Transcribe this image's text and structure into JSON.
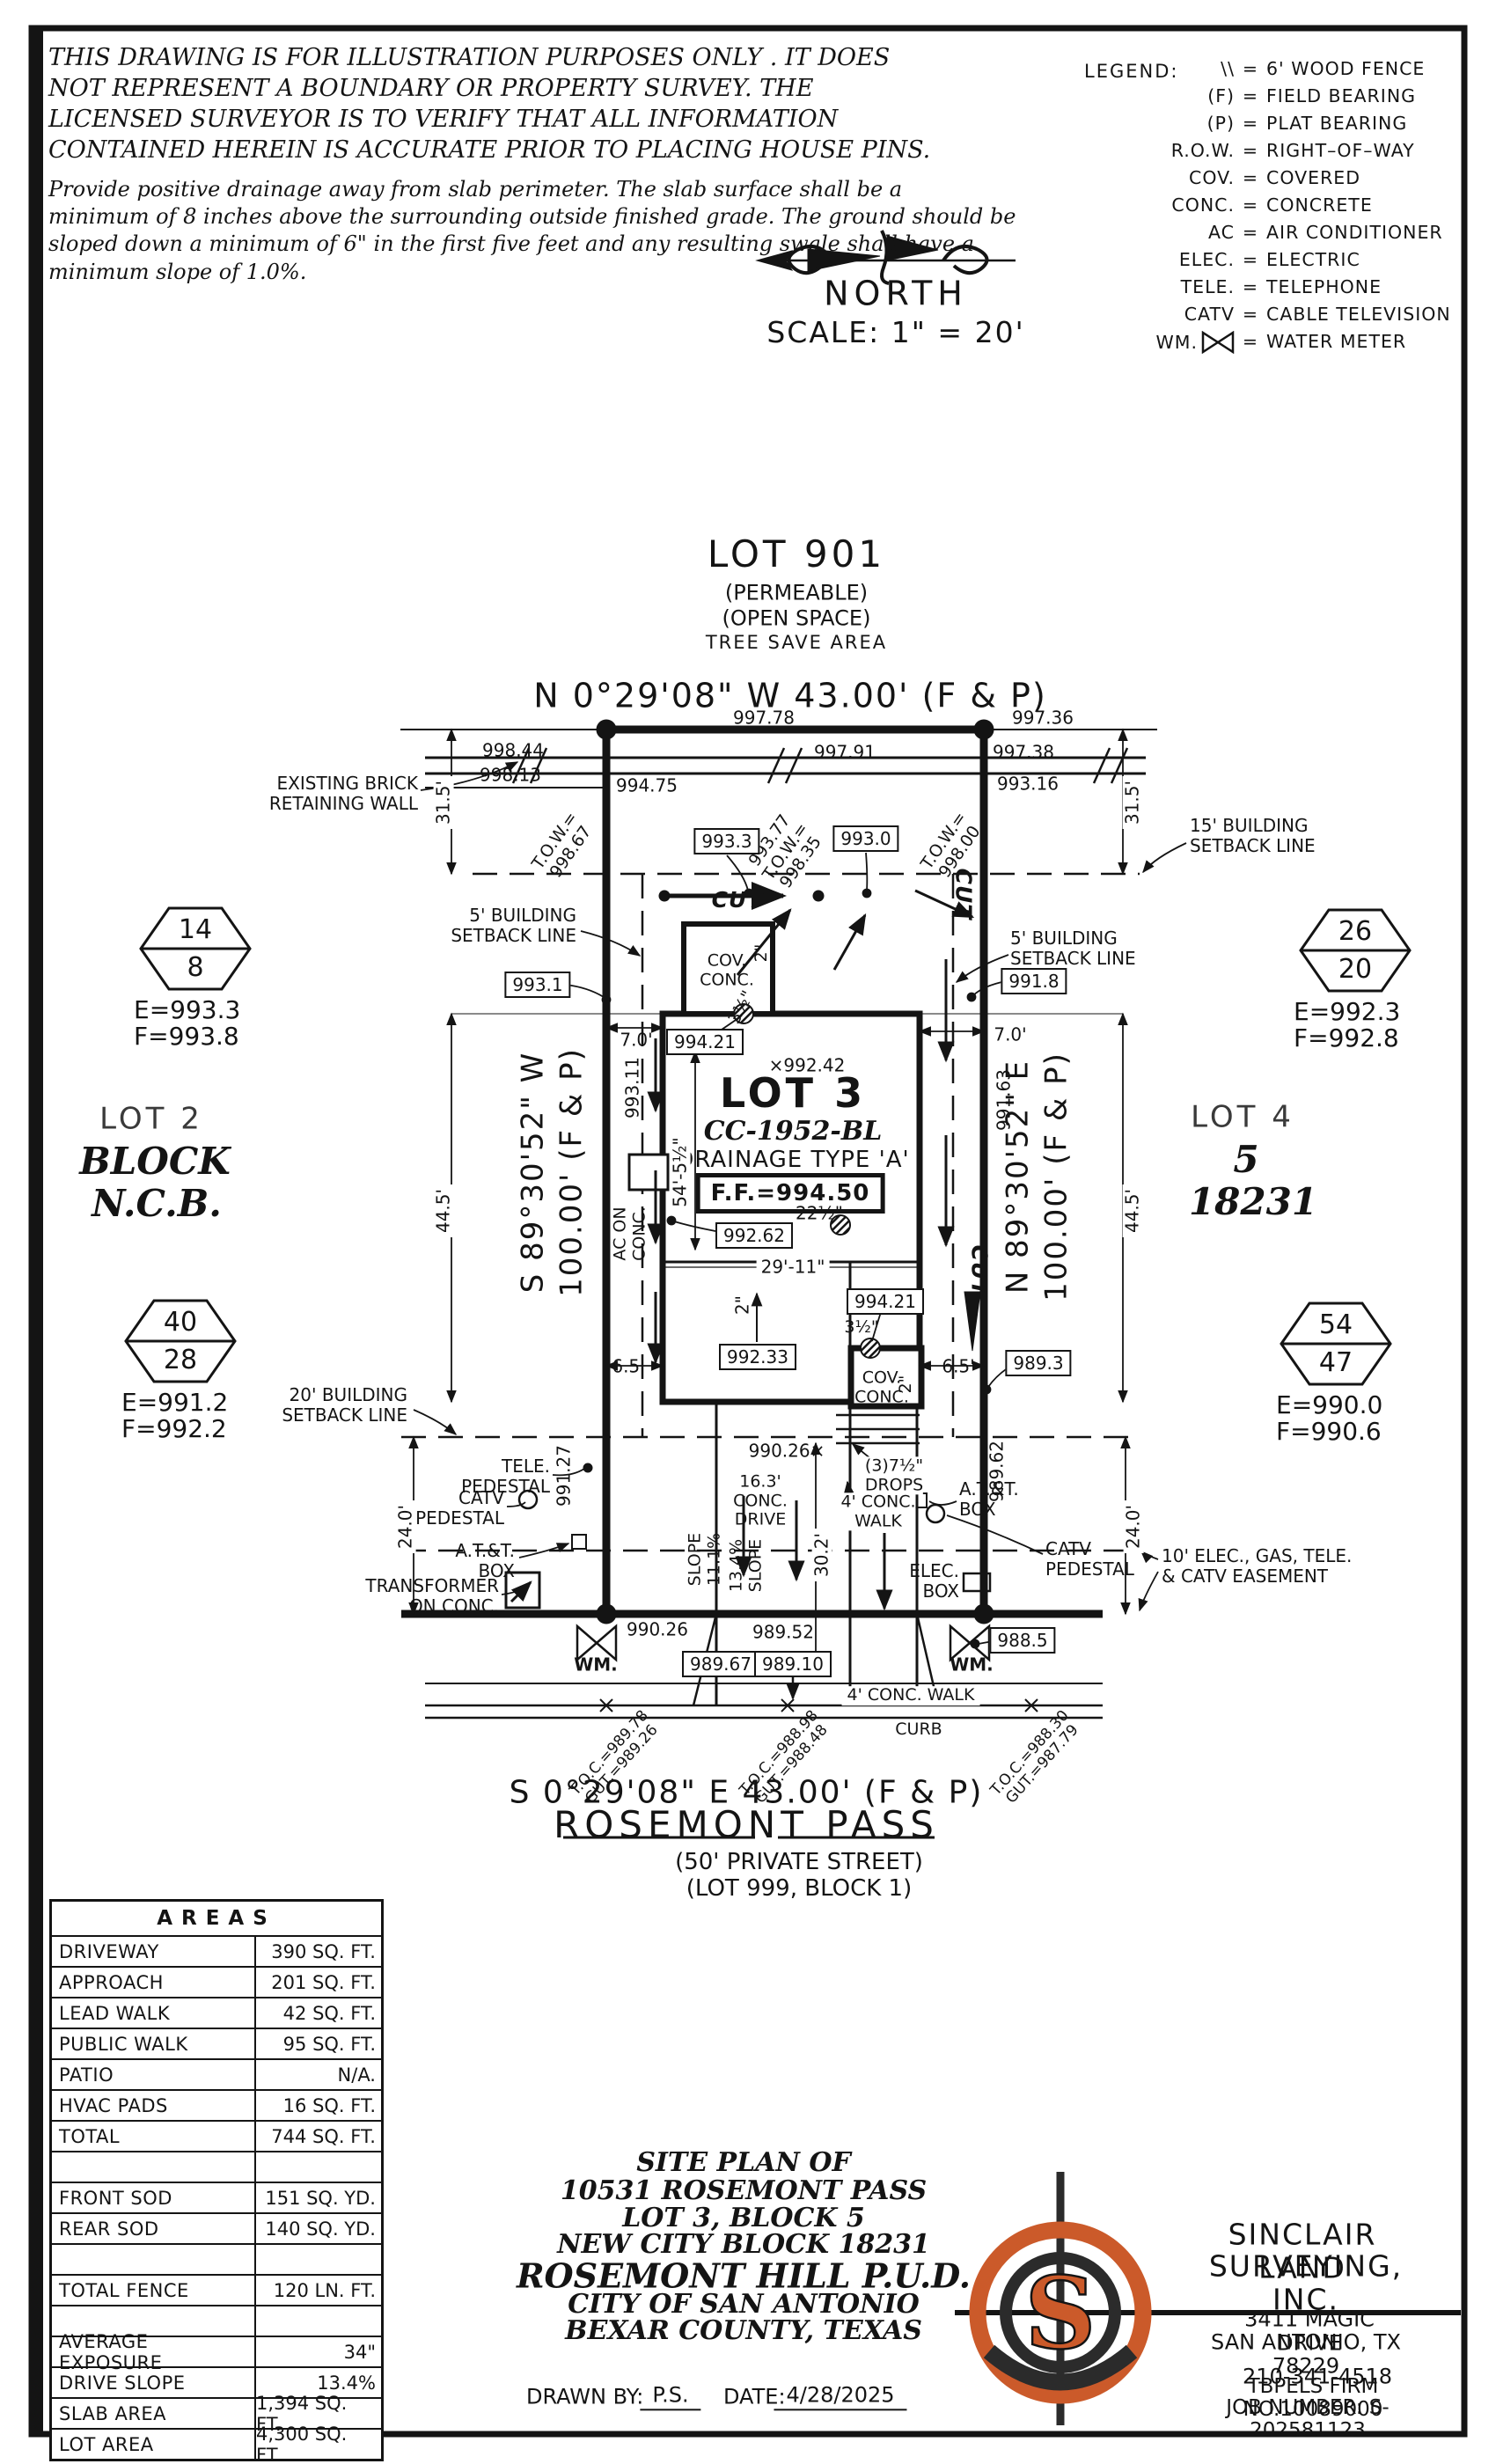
{
  "colors": {
    "accent": "#cb5a2a",
    "ink": "#141414"
  },
  "notes": {
    "disclaimer": "THIS DRAWING IS FOR ILLUSTRATION PURPOSES ONLY . IT DOES\nNOT REPRESENT A BOUNDARY OR PROPERTY SURVEY. THE\nLICENSED SURVEYOR IS TO VERIFY THAT ALL INFORMATION\nCONTAINED HEREIN IS ACCURATE PRIOR TO PLACING HOUSE PINS.",
    "drainage_note": "Provide positive drainage away from slab perimeter. The slab surface shall be a\nminimum of 8 inches above the surrounding outside finished grade. The ground should be\nsloped down a minimum of 6\" in the first five feet and any resulting swale shall have a\nminimum slope of 1.0%."
  },
  "compass": {
    "north": "NORTH",
    "scale": "SCALE: 1\" = 20'"
  },
  "legend": {
    "title": "LEGEND:",
    "rows": [
      {
        "sym": "\\\\",
        "def": "6' WOOD FENCE"
      },
      {
        "sym": "(F)",
        "def": "FIELD BEARING"
      },
      {
        "sym": "(P)",
        "def": "PLAT BEARING"
      },
      {
        "sym": "R.O.W.",
        "def": "RIGHT–OF–WAY"
      },
      {
        "sym": "COV.",
        "def": "COVERED"
      },
      {
        "sym": "CONC.",
        "def": "CONCRETE"
      },
      {
        "sym": "AC",
        "def": "AIR CONDITIONER"
      },
      {
        "sym": "ELEC.",
        "def": "ELECTRIC"
      },
      {
        "sym": "TELE.",
        "def": "TELEPHONE"
      },
      {
        "sym": "CATV",
        "def": "CABLE TELEVISION"
      },
      {
        "sym": "WM.",
        "def": "WATER METER"
      }
    ]
  },
  "lot901": {
    "title": "LOT 901",
    "sub1": "(PERMEABLE)",
    "sub2": "(OPEN SPACE)",
    "sub3": "TREE SAVE AREA"
  },
  "bearings": {
    "north": "N 0°29'08\" W 43.00' (F & P)",
    "south": "S 0°29'08\" E 43.00' (F & P)",
    "west_dir": "S 89°30'52\" W",
    "west_len": "100.00' (F & P)",
    "east_dir": "N 89°30'52\" E",
    "east_len": "100.00' (F & P)"
  },
  "street": {
    "name": "ROSEMONT PASS",
    "type": "(50' PRIVATE STREET)",
    "lot": "(LOT 999, BLOCK 1)"
  },
  "neighbors": {
    "west": [
      "LOT 2",
      "BLOCK",
      "N.C.B."
    ],
    "east": [
      "LOT 4",
      "5",
      "18231"
    ]
  },
  "markers": [
    {
      "top": "14",
      "bottom": "8",
      "e": "E=993.3",
      "f": "F=993.8"
    },
    {
      "top": "40",
      "bottom": "28",
      "e": "E=991.2",
      "f": "F=992.2"
    },
    {
      "top": "26",
      "bottom": "20",
      "e": "E=992.3",
      "f": "F=992.8"
    },
    {
      "top": "54",
      "bottom": "47",
      "e": "E=990.0",
      "f": "F=990.6"
    }
  ],
  "house": {
    "lot": "LOT 3",
    "plan": "CC-1952-BL",
    "drainage": "DRAINAGE TYPE 'A'",
    "ff": "F.F.=994.50"
  },
  "ann": {
    "wall": "EXISTING BRICK\nRETAINING WALL",
    "e99844": "998.44",
    "e99813": "998.13",
    "e99475": "994.75",
    "e99778": "997.78",
    "e99736": "997.36",
    "e99791": "997.91",
    "e99738": "997.38",
    "e99316": "993.16",
    "towL": "T.O.W.=\n998.67",
    "towM": "993.77\nT.O.W.=\n998.35",
    "towR": "T.O.W.=\n998.00",
    "d315": "31.5'",
    "sb15": "15' BUILDING\nSETBACK LINE",
    "sb5": "5' BUILDING\nSETBACK LINE",
    "sb20": "20' BUILDING\nSETBACK LINE",
    "cut": "CUT",
    "e9933": "993.3",
    "e9930": "993.0",
    "e9931": "993.1",
    "e9918": "991.8",
    "d70": "7.0'",
    "v99311": "993.11",
    "v99163": "991.63",
    "x99242": "×992.42",
    "e99421": "994.21",
    "d22": "22½\"",
    "e99262": "992.62",
    "d2911": "29'-11\"",
    "d2": "2\"",
    "e99233": "992.33",
    "d35": "3½\"",
    "cov": "COV.\nCONC.",
    "d65": "6.5'",
    "d54": "54'-5½\"",
    "ac": "AC ON\nCONC.",
    "d445": "44.5'",
    "e9893": "989.3",
    "d240": "24.0'",
    "tele": "TELE.\nPEDESTAL",
    "catv": "CATV\nPEDESTAL",
    "att": "A.T.&T.\nBOX",
    "xfmr": "TRANSFORMER\nON CONC.",
    "v99127": "991.27",
    "x99026": "990.26×",
    "drive": "16.3'\nCONC.\nDRIVE",
    "slope1": "SLOPE\n11.1%",
    "slope2": "13.4%\nSLOPE",
    "d302": "30.2'",
    "drops": "(3)7½\"\nDROPS",
    "walk": "4' CONC.\nWALK",
    "v98962": "989.62",
    "elec": "ELEC.\nBOX",
    "easement": "10' ELEC., GAS, TELE.\n& CATV EASEMENT",
    "wm": "WM.",
    "e9885": "988.5",
    "e99026": "990.26",
    "e98952": "989.52",
    "e98967": "989.67",
    "e98910": "989.10",
    "walk2": "4' CONC. WALK",
    "curb": "CURB",
    "toc1": "T.O.C.=989.78\nGUT.=989.26",
    "toc2": "T.O.C.=988.98\nGUT.=988.48",
    "toc3": "T.O.C.=988.30\nGUT.=987.79"
  },
  "areas": {
    "title": "AREAS",
    "rows": [
      [
        "DRIVEWAY",
        "390 SQ. FT."
      ],
      [
        "APPROACH",
        "201 SQ. FT."
      ],
      [
        "LEAD WALK",
        "42 SQ. FT."
      ],
      [
        "PUBLIC WALK",
        "95 SQ. FT."
      ],
      [
        "PATIO",
        "N/A."
      ],
      [
        "HVAC PADS",
        "16 SQ. FT."
      ],
      [
        "TOTAL",
        "744 SQ. FT."
      ],
      [
        "",
        ""
      ],
      [
        "FRONT SOD",
        "151 SQ. YD."
      ],
      [
        "REAR SOD",
        "140 SQ. YD."
      ],
      [
        "",
        ""
      ],
      [
        "TOTAL FENCE",
        "120 LN. FT."
      ],
      [
        "",
        ""
      ],
      [
        "AVERAGE EXPOSURE",
        "34\""
      ],
      [
        "DRIVE SLOPE",
        "13.4%"
      ],
      [
        "SLAB AREA",
        "1,394 SQ. FT."
      ],
      [
        "LOT AREA",
        "4,300 SQ. FT."
      ]
    ]
  },
  "title_block": {
    "line1": "SITE PLAN OF",
    "line2": "10531 ROSEMONT PASS",
    "line3": "LOT 3, BLOCK 5",
    "line4": "NEW CITY BLOCK 18231",
    "line5": "ROSEMONT HILL P.U.D.",
    "line6": "CITY OF SAN ANTONIO",
    "line7": "BEXAR COUNTY, TEXAS",
    "drawn_label": "DRAWN BY:",
    "drawn_by": "P.S.",
    "date_label": "DATE:",
    "date": "4/28/2025"
  },
  "firm": {
    "name1": "SINCLAIR LAND",
    "name2": "SURVEYING, INC.",
    "address1": "3411 MAGIC DRIVE",
    "address2": "SAN ANTONIO, TX 78229",
    "phone": "210-341-4518",
    "license": "TBPELS FIRM NO.10089000",
    "job": "JOB NUMBER: S-202581123",
    "monogram": "S"
  }
}
